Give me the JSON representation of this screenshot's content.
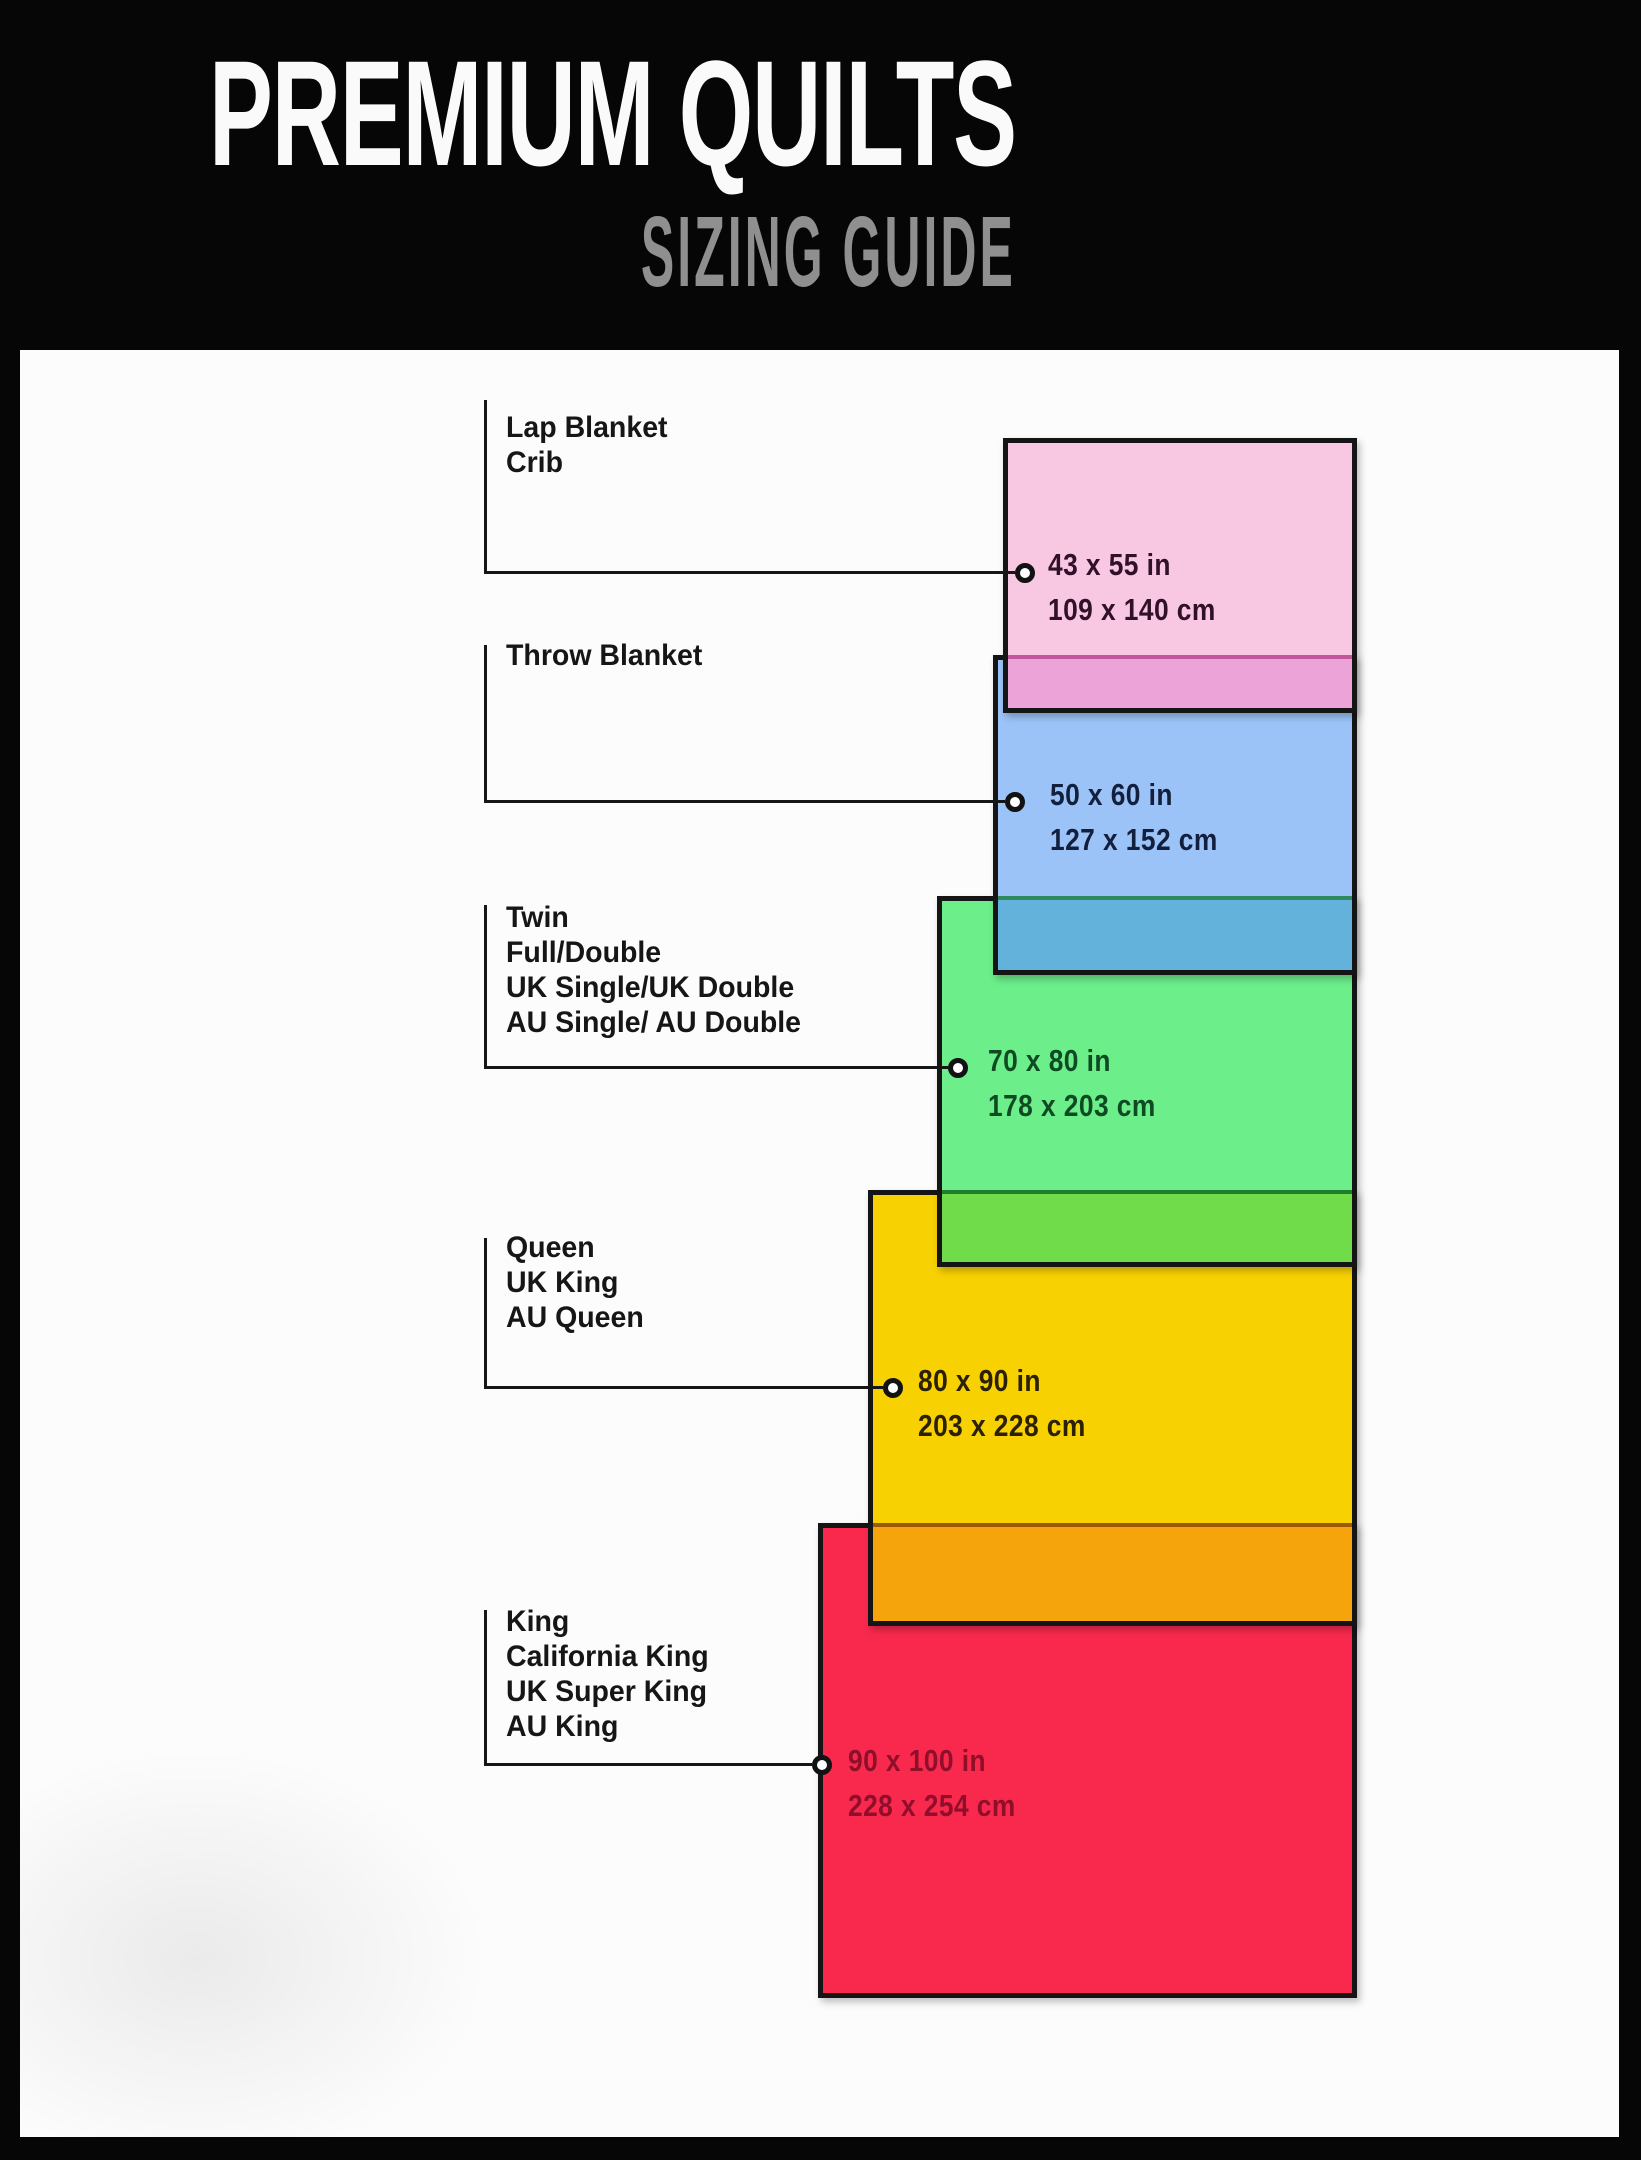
{
  "header": {
    "title": "PREMIUM QUILTS",
    "subtitle": "SIZING GUIDE"
  },
  "sizes": [
    {
      "name": "lap-blanket-crib",
      "labels": [
        "Lap Blanket",
        "Crib"
      ],
      "size_in": "43 x 55 in",
      "size_cm": "109 x 140 cm",
      "fill": "#F8C8E3",
      "overlap_fill": "#EBA3D8",
      "text_color": "#31102A"
    },
    {
      "name": "throw-blanket",
      "labels": [
        "Throw Blanket"
      ],
      "size_in": "50 x 60 in",
      "size_cm": "127 x 152 cm",
      "fill": "#9CC3F7",
      "overlap_fill": "#63B2DC",
      "text_color": "#13203D"
    },
    {
      "name": "twin-full-double",
      "labels": [
        "Twin",
        "Full/Double",
        "UK Single/UK Double",
        "AU Single/ AU Double"
      ],
      "size_in": "70 x 80 in",
      "size_cm": "178 x 203 cm",
      "fill": "#6CEE8A",
      "overlap_fill": "#70DC49",
      "text_color": "#0F4A22"
    },
    {
      "name": "queen",
      "labels": [
        "Queen",
        "UK King",
        "AU Queen"
      ],
      "size_in": "80 x 90 in",
      "size_cm": "203 x 228 cm",
      "fill": "#F8D103",
      "overlap_fill": "#F6A40B",
      "text_color": "#2B2001"
    },
    {
      "name": "king",
      "labels": [
        "King",
        "California King",
        "UK Super King",
        "AU King"
      ],
      "size_in": "90 x 100 in",
      "size_cm": "228 x 254 cm",
      "fill": "#F9294E",
      "overlap_fill": "",
      "text_color": "#8F0F2B"
    }
  ]
}
